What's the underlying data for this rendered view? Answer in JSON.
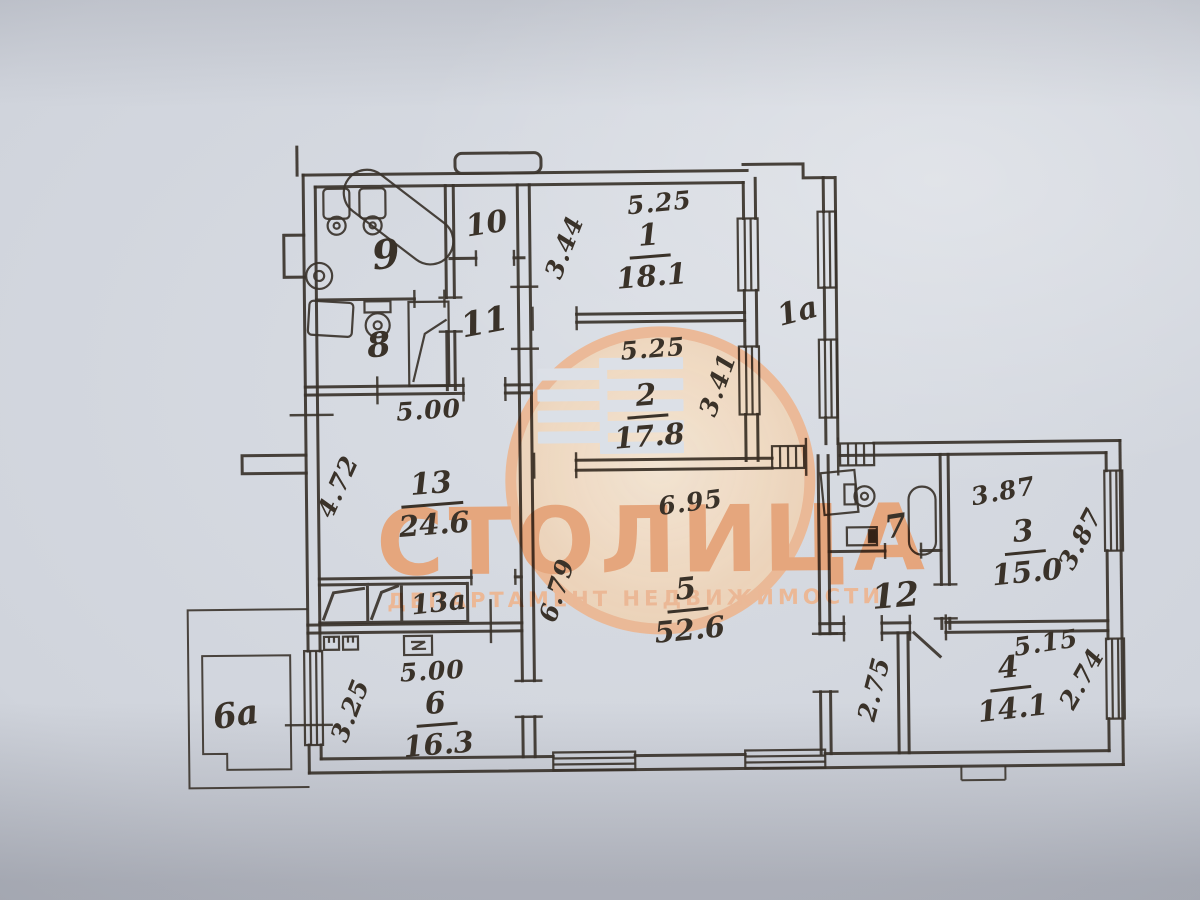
{
  "document": {
    "type": "apartment-floor-plan-photo",
    "ink_color": "#3a3229",
    "paper_color": "#d2d6de"
  },
  "watermark": {
    "brand": "СТОЛИЦА",
    "tagline": "ДЕПАРТАМЕНТ НЕДВИЖИМОСТИ",
    "ring_color": "#edb58f",
    "text_color": "#e7a072"
  },
  "rooms": {
    "r1": {
      "num": "1",
      "area": "18.1"
    },
    "r2": {
      "num": "2",
      "area": "17.8"
    },
    "r3": {
      "num": "3",
      "area": "15.0"
    },
    "r4": {
      "num": "4",
      "area": "14.1"
    },
    "r5": {
      "num": "5",
      "area": "52.6"
    },
    "r6": {
      "num": "6",
      "area": "16.3"
    },
    "r13": {
      "num": "13",
      "area": "24.6"
    },
    "r7": {
      "num": "7"
    },
    "r8": {
      "num": "8"
    },
    "r9": {
      "num": "9"
    },
    "r10": {
      "num": "10"
    },
    "r11": {
      "num": "11"
    },
    "r12": {
      "num": "12"
    },
    "r1a": {
      "num": "1а"
    },
    "r6a": {
      "num": "6а"
    },
    "r13a": {
      "num": "13а"
    }
  },
  "dims": {
    "r1w": "5.25",
    "r1h": "3.44",
    "r2w": "5.25",
    "r2h": "3.41",
    "r13w": "5.00",
    "r13h": "4.72",
    "r5w": "6.95",
    "r5h": "6.79",
    "r6w": "5.00",
    "r6h": "3.25",
    "hall": "2.75",
    "r3w": "3.87",
    "r3h": "3.87",
    "r4w": "5.15",
    "r4h": "2.74"
  }
}
